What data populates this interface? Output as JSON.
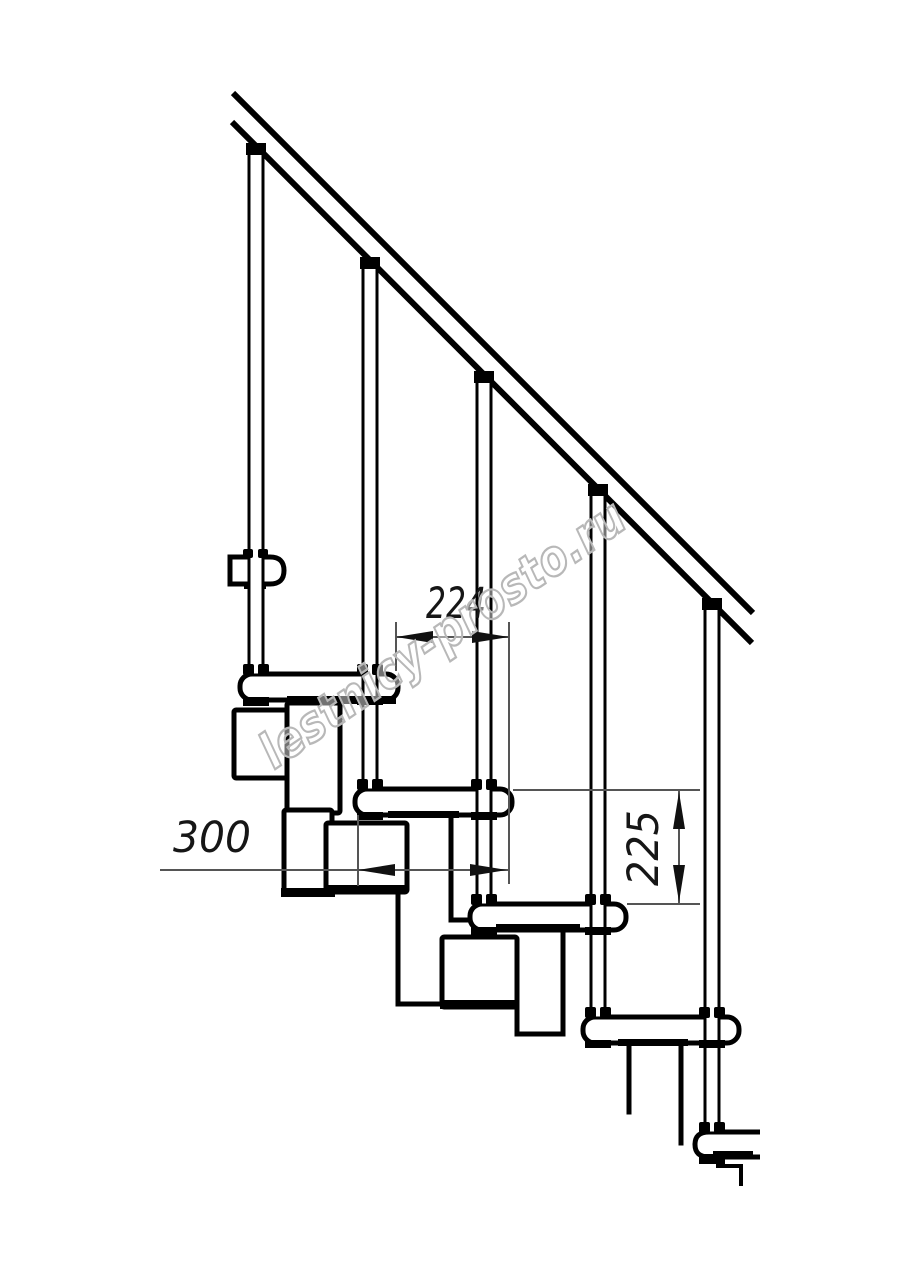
{
  "drawing": {
    "type": "staircase-side-view-technical-drawing",
    "balusters_count": 5,
    "treads_count": 5
  },
  "dimensions": {
    "step_run": {
      "value": "224"
    },
    "tread_depth": {
      "value": "300"
    },
    "step_rise": {
      "value": "225"
    }
  },
  "watermark": {
    "text": "lestnicy-prosto.ru"
  },
  "colors": {
    "ink": "#000000",
    "paper": "#ffffff",
    "dim_line": "#555555",
    "dim_arrow": "#111111",
    "dim_text": "#161616",
    "watermark_stroke": "#b8b8b8"
  }
}
